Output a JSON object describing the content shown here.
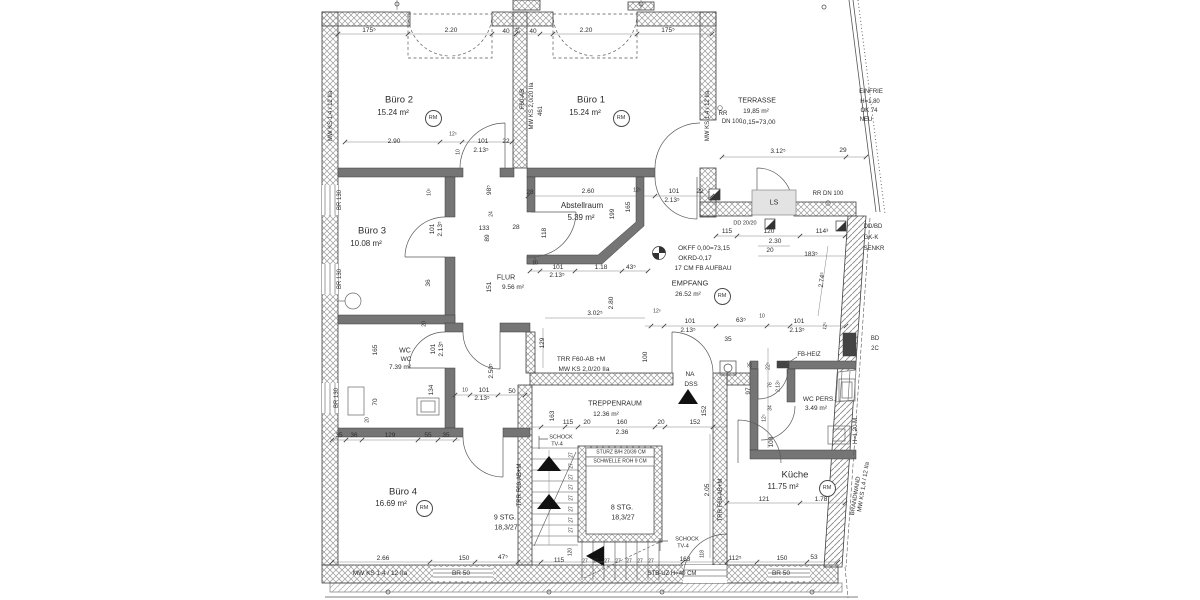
{
  "drawing_type": "architectural-floor-plan-office-storey",
  "rm_label": "RM",
  "rooms": [
    {
      "id": "buero-2",
      "name": "Büro 2",
      "area": "15.24 m²",
      "nx": 399,
      "ny": 100,
      "ax": 393,
      "ay": 113,
      "s": 9.5,
      "rx": 432,
      "ry": 117
    },
    {
      "id": "buero-1",
      "name": "Büro 1",
      "area": "15.24 m²",
      "nx": 591,
      "ny": 100,
      "ax": 585,
      "ay": 113,
      "s": 9.5,
      "rx": 620,
      "ry": 117
    },
    {
      "id": "buero-3",
      "name": "Büro 3",
      "area": "10.08 m²",
      "nx": 372,
      "ny": 231,
      "ax": 366,
      "ay": 244,
      "s": 9.5
    },
    {
      "id": "buero-4",
      "name": "Büro 4",
      "area": "16.69 m²",
      "nx": 403,
      "ny": 492,
      "ax": 391,
      "ay": 504,
      "s": 9.5,
      "rx": 423,
      "ry": 507
    },
    {
      "id": "abstellraum",
      "name": "Abstellraum",
      "area": "5.39 m²",
      "nx": 582,
      "ny": 206,
      "ax": 581,
      "ay": 218,
      "s": 8
    },
    {
      "id": "flur",
      "name": "FLUR",
      "area": "9.56 m²",
      "nx": 506,
      "ny": 278,
      "ax": 513,
      "ay": 288,
      "s": 7,
      "small": true
    },
    {
      "id": "wc",
      "name": "WC",
      "area": "7.39 m²",
      "nx": 405,
      "ny": 351,
      "ax": 400,
      "ay": 368,
      "s": 7,
      "small": true,
      "extra": "WC",
      "ex": 406,
      "ey": 360
    },
    {
      "id": "empfang",
      "name": "EMPFANG",
      "area": "26.52 m²",
      "nx": 690,
      "ny": 283,
      "ax": 688,
      "ay": 295,
      "s": 7.5,
      "small": true,
      "rx": 721,
      "ry": 295
    },
    {
      "id": "treppenraum",
      "name": "TREPPENRAUM",
      "area": "12.36 m²",
      "nx": 615,
      "ny": 404,
      "ax": 606,
      "ay": 415,
      "s": 7,
      "small": true
    },
    {
      "id": "wc-pers",
      "name": "WC PERS.",
      "area": "3.49 m²",
      "nx": 819,
      "ny": 400,
      "ax": 816,
      "ay": 409,
      "s": 6.5,
      "small": true
    },
    {
      "id": "kueche",
      "name": "Küche",
      "area": "11.75 m²",
      "nx": 795,
      "ny": 475,
      "ax": 783,
      "ay": 487,
      "s": 9.5,
      "rx": 826,
      "ry": 487
    },
    {
      "id": "terrasse",
      "name": "TERRASSE",
      "area": "19,85 m²",
      "nx": 757,
      "ny": 101,
      "ax": 756,
      "ay": 112,
      "s": 7,
      "small": true,
      "extra": "-0,15=73,00",
      "ex": 758,
      "ey": 123
    }
  ],
  "labels": [
    {
      "t": "175⁵",
      "x": 369,
      "y": 31
    },
    {
      "t": "2.20",
      "x": 451,
      "y": 31
    },
    {
      "t": "40",
      "x": 506,
      "y": 32
    },
    {
      "t": "24",
      "x": 519,
      "y": 30,
      "r": -90,
      "s": 5
    },
    {
      "t": "40",
      "x": 533,
      "y": 32
    },
    {
      "t": "2.20",
      "x": 586,
      "y": 31
    },
    {
      "t": "175⁵",
      "x": 668,
      "y": 31
    },
    {
      "n": "wall-spec",
      "t": "MW KS 1,4 / 12 IIa",
      "x": 331,
      "y": 116,
      "r": -90,
      "s": 6
    },
    {
      "n": "wall-spec",
      "t": "F60-AB",
      "x": 523,
      "y": 99,
      "r": -90,
      "s": 6
    },
    {
      "n": "wall-spec",
      "t": "MW KS 2,0/20 IIa",
      "x": 532,
      "y": 106,
      "r": -90,
      "s": 6
    },
    {
      "t": "461",
      "x": 541,
      "y": 111,
      "r": -90,
      "s": 6
    },
    {
      "n": "wall-spec",
      "t": "MW KS 1,4 / 12 IIa",
      "x": 708,
      "y": 116,
      "r": -90,
      "s": 6
    },
    {
      "t": "2.90",
      "x": 394,
      "y": 142
    },
    {
      "t": "12⁵",
      "x": 453,
      "y": 135,
      "s": 5
    },
    {
      "t": "10",
      "x": 459,
      "y": 152,
      "r": -90,
      "s": 5
    },
    {
      "t": "101",
      "x": 483,
      "y": 142
    },
    {
      "t": "2.13⁵",
      "x": 481,
      "y": 151
    },
    {
      "t": "22",
      "x": 506,
      "y": 142
    },
    {
      "t": "28",
      "x": 530,
      "y": 193
    },
    {
      "t": "2.60",
      "x": 588,
      "y": 192
    },
    {
      "t": "12⁵",
      "x": 637,
      "y": 191,
      "s": 5
    },
    {
      "t": "165",
      "x": 629,
      "y": 207,
      "r": -90
    },
    {
      "t": "199",
      "x": 613,
      "y": 214,
      "r": -90
    },
    {
      "t": "101",
      "x": 674,
      "y": 192
    },
    {
      "t": "2.13⁵",
      "x": 672,
      "y": 201
    },
    {
      "t": "22",
      "x": 700,
      "y": 192
    },
    {
      "t": "3.12⁵",
      "x": 778,
      "y": 152
    },
    {
      "t": "29",
      "x": 843,
      "y": 151
    },
    {
      "n": "drain-note",
      "t": "RR",
      "x": 723,
      "y": 114,
      "s": 6
    },
    {
      "n": "drain-note",
      "t": "DN 100",
      "x": 732,
      "y": 122,
      "s": 6
    },
    {
      "n": "fence-note",
      "t": "EINFRIE",
      "x": 871,
      "y": 92,
      "s": 6
    },
    {
      "n": "fence-note",
      "t": "H=1,80",
      "x": 870,
      "y": 102,
      "s": 6
    },
    {
      "n": "fence-note",
      "t": "OK 74",
      "x": 869,
      "y": 111,
      "s": 6
    },
    {
      "n": "fence-note",
      "t": "NEU",
      "x": 866,
      "y": 120,
      "s": 6
    },
    {
      "n": "shaft-label",
      "t": "LS",
      "x": 774,
      "y": 203,
      "s": 7
    },
    {
      "n": "drain-note",
      "t": "RR DN 100",
      "x": 828,
      "y": 194,
      "s": 6
    },
    {
      "n": "ceiling-note",
      "t": "DD 20/20",
      "x": 745,
      "y": 224,
      "s": 5.5
    },
    {
      "n": "ceiling-note",
      "t": "DD/BD",
      "x": 873,
      "y": 227,
      "s": 6
    },
    {
      "n": "ceiling-note",
      "t": "GK-K",
      "x": 871,
      "y": 238,
      "s": 6
    },
    {
      "n": "ceiling-note",
      "t": "SENKR",
      "x": 874,
      "y": 249,
      "s": 6
    },
    {
      "t": "115",
      "x": 727,
      "y": 232
    },
    {
      "t": "120",
      "x": 769,
      "y": 232
    },
    {
      "t": "114³",
      "x": 822,
      "y": 232
    },
    {
      "t": "2.30",
      "x": 775,
      "y": 242
    },
    {
      "t": "20",
      "x": 770,
      "y": 251
    },
    {
      "t": "183⁵",
      "x": 811,
      "y": 255
    },
    {
      "t": "2.74⁵",
      "x": 823,
      "y": 280,
      "r": -83
    },
    {
      "n": "level-note",
      "t": "OKFF 0,00=73,15",
      "x": 704,
      "y": 249,
      "s": 6.5
    },
    {
      "n": "level-note",
      "t": "OKRD-0,17",
      "x": 695,
      "y": 259,
      "s": 6.5
    },
    {
      "n": "level-note",
      "t": "17 CM FB AUFBAU",
      "x": 703,
      "y": 269,
      "s": 6.5
    },
    {
      "t": "98⁵",
      "x": 490,
      "y": 190,
      "r": -90
    },
    {
      "t": "24",
      "x": 492,
      "y": 214,
      "r": -90,
      "s": 5
    },
    {
      "t": "133",
      "x": 484,
      "y": 229
    },
    {
      "t": "28",
      "x": 516,
      "y": 228
    },
    {
      "t": "89",
      "x": 488,
      "y": 238,
      "r": -90
    },
    {
      "t": "118",
      "x": 545,
      "y": 233,
      "r": -90
    },
    {
      "t": "10⁵",
      "x": 430,
      "y": 192,
      "r": -90,
      "s": 5
    },
    {
      "t": "101",
      "x": 433,
      "y": 229,
      "r": -90
    },
    {
      "t": "2.13⁵",
      "x": 441,
      "y": 229,
      "r": -90
    },
    {
      "t": "36",
      "x": 429,
      "y": 283,
      "r": -90
    },
    {
      "t": "20",
      "x": 425,
      "y": 324,
      "r": -90,
      "s": 5
    },
    {
      "t": "151",
      "x": 490,
      "y": 287,
      "r": -90
    },
    {
      "t": "10",
      "x": 535,
      "y": 264,
      "s": 5
    },
    {
      "t": "101",
      "x": 558,
      "y": 268
    },
    {
      "t": "2.13⁵",
      "x": 557,
      "y": 276
    },
    {
      "t": "1.18",
      "x": 601,
      "y": 268
    },
    {
      "t": "43⁵",
      "x": 631,
      "y": 268
    },
    {
      "t": "3.02⁵",
      "x": 595,
      "y": 314
    },
    {
      "t": "2.80",
      "x": 612,
      "y": 303,
      "r": -90
    },
    {
      "t": "12⁵",
      "x": 657,
      "y": 312,
      "s": 5
    },
    {
      "t": "101",
      "x": 690,
      "y": 322
    },
    {
      "t": "2.13⁵",
      "x": 688,
      "y": 331
    },
    {
      "t": "63⁵",
      "x": 741,
      "y": 321
    },
    {
      "t": "10",
      "x": 762,
      "y": 317,
      "s": 5
    },
    {
      "t": "101",
      "x": 799,
      "y": 322
    },
    {
      "t": "2.13⁵",
      "x": 797,
      "y": 331
    },
    {
      "t": "12⁵",
      "x": 826,
      "y": 326,
      "r": -80,
      "s": 5
    },
    {
      "t": "129",
      "x": 543,
      "y": 343,
      "r": -90
    },
    {
      "t": "100",
      "x": 646,
      "y": 357,
      "r": -90
    },
    {
      "n": "wall-spec",
      "t": "TRR F60-AB +M",
      "x": 581,
      "y": 360,
      "s": 6.5
    },
    {
      "n": "wall-spec",
      "t": "MW KS 2,0/20 IIa",
      "x": 584,
      "y": 370,
      "s": 6.5
    },
    {
      "n": "vent-note",
      "t": "NA",
      "x": 690,
      "y": 375,
      "s": 6.5
    },
    {
      "n": "vent-note",
      "t": "DSS",
      "x": 691,
      "y": 385,
      "s": 6.5
    },
    {
      "t": "35",
      "x": 728,
      "y": 340
    },
    {
      "t": "35",
      "x": 751,
      "y": 365,
      "r": -90,
      "s": 5
    },
    {
      "t": "22⁵",
      "x": 769,
      "y": 366,
      "r": -90,
      "s": 5
    },
    {
      "t": "97",
      "x": 749,
      "y": 391,
      "r": -90
    },
    {
      "t": "76",
      "x": 771,
      "y": 385,
      "r": -90,
      "s": 5
    },
    {
      "t": "2.13⁵",
      "x": 779,
      "y": 386,
      "r": -90,
      "s": 5
    },
    {
      "t": "34",
      "x": 771,
      "y": 408,
      "r": -90,
      "s": 5
    },
    {
      "t": "12⁵",
      "x": 765,
      "y": 418,
      "r": -90,
      "s": 5
    },
    {
      "t": "100",
      "x": 772,
      "y": 442,
      "r": -90
    },
    {
      "n": "heating-note",
      "t": "FB-HEIZ",
      "x": 809,
      "y": 355,
      "s": 6
    },
    {
      "t": "165",
      "x": 376,
      "y": 350,
      "r": -90
    },
    {
      "t": "101",
      "x": 434,
      "y": 349,
      "r": -90
    },
    {
      "t": "2.13⁵",
      "x": 442,
      "y": 349,
      "r": -90
    },
    {
      "t": "2.50⁵",
      "x": 492,
      "y": 371,
      "r": -90
    },
    {
      "t": "134",
      "x": 432,
      "y": 390,
      "r": -90
    },
    {
      "t": "70",
      "x": 376,
      "y": 402,
      "r": -90
    },
    {
      "t": "20",
      "x": 368,
      "y": 420,
      "r": -90,
      "s": 5
    },
    {
      "t": "10",
      "x": 465,
      "y": 391,
      "s": 5
    },
    {
      "t": "101",
      "x": 484,
      "y": 391
    },
    {
      "t": "2.13⁵",
      "x": 482,
      "y": 399
    },
    {
      "t": "50",
      "x": 512,
      "y": 392
    },
    {
      "t": "35",
      "x": 339,
      "y": 436
    },
    {
      "t": "36",
      "x": 354,
      "y": 436
    },
    {
      "t": "129",
      "x": 390,
      "y": 436
    },
    {
      "t": "55",
      "x": 428,
      "y": 436
    },
    {
      "t": "35",
      "x": 446,
      "y": 436
    },
    {
      "t": "163",
      "x": 553,
      "y": 416,
      "r": -90
    },
    {
      "t": "115",
      "x": 568,
      "y": 423
    },
    {
      "t": "20",
      "x": 587,
      "y": 423
    },
    {
      "t": "160",
      "x": 622,
      "y": 423
    },
    {
      "t": "20",
      "x": 661,
      "y": 423
    },
    {
      "t": "152",
      "x": 695,
      "y": 423
    },
    {
      "t": "2.36",
      "x": 622,
      "y": 433
    },
    {
      "t": "152",
      "x": 705,
      "y": 411,
      "r": -90
    },
    {
      "t": "2.05",
      "x": 708,
      "y": 490,
      "r": -90
    },
    {
      "n": "lintel-note",
      "t": "STURZ B/H 20/39 CM",
      "x": 621,
      "y": 453,
      "s": 5
    },
    {
      "n": "lintel-note",
      "t": "SCHWELLE ROH 9 CM",
      "x": 620,
      "y": 462,
      "s": 5
    },
    {
      "n": "stair-note",
      "t": "8 STG.",
      "x": 622,
      "y": 508,
      "s": 7
    },
    {
      "n": "stair-note",
      "t": "18,3/27",
      "x": 623,
      "y": 518,
      "s": 7
    },
    {
      "n": "stair-note",
      "t": "9 STG.",
      "x": 505,
      "y": 518,
      "s": 7
    },
    {
      "n": "stair-note",
      "t": "18,3/27",
      "x": 506,
      "y": 528,
      "s": 7
    },
    {
      "n": "sound-insulation-note",
      "t": "SCHOCK",
      "x": 561,
      "y": 438,
      "s": 5.5
    },
    {
      "n": "sound-insulation-note",
      "t": "TV-4",
      "x": 557,
      "y": 445,
      "s": 5.5
    },
    {
      "n": "sound-insulation-note",
      "t": "SCHOCK",
      "x": 687,
      "y": 540,
      "s": 5.5
    },
    {
      "n": "sound-insulation-note",
      "t": "TV-4",
      "x": 683,
      "y": 547,
      "s": 5.5
    },
    {
      "n": "wall-spec",
      "t": "TRR F60-AB+M",
      "x": 520,
      "y": 485,
      "r": -90,
      "s": 6
    },
    {
      "n": "wall-spec",
      "t": "TRR F60-AB+M",
      "x": 721,
      "y": 500,
      "r": -90,
      "s": 6
    },
    {
      "t": "120",
      "x": 571,
      "y": 552,
      "r": -90,
      "s": 5
    },
    {
      "t": "118",
      "x": 703,
      "y": 554,
      "r": -90,
      "s": 5
    },
    {
      "t": "2.66",
      "x": 383,
      "y": 559
    },
    {
      "t": "150",
      "x": 464,
      "y": 559
    },
    {
      "t": "47⁵",
      "x": 503,
      "y": 558
    },
    {
      "t": "115",
      "x": 559,
      "y": 561
    },
    {
      "t": "163",
      "x": 685,
      "y": 560
    },
    {
      "t": "112⁵",
      "x": 735,
      "y": 559
    },
    {
      "t": "150",
      "x": 782,
      "y": 559
    },
    {
      "t": "53",
      "x": 814,
      "y": 558
    },
    {
      "n": "wall-spec",
      "t": "MW KS 1,4 / 12 IIa",
      "x": 380,
      "y": 574,
      "s": 6.5
    },
    {
      "n": "window-note",
      "t": "BR 50",
      "x": 461,
      "y": 574,
      "s": 6.5
    },
    {
      "n": "window-note",
      "t": "BR 50",
      "x": 781,
      "y": 574,
      "s": 6.5
    },
    {
      "n": "beam-note",
      "t": "STB-UZ H=40 CM",
      "x": 672,
      "y": 574,
      "s": 6
    },
    {
      "t": "121",
      "x": 764,
      "y": 500
    },
    {
      "t": "1.78",
      "x": 821,
      "y": 500
    },
    {
      "n": "parapet-note",
      "t": "H=1,20 M",
      "x": 856,
      "y": 431,
      "r": -90,
      "s": 6
    },
    {
      "n": "wall-spec",
      "t": "MW KS 1,4 / 12 IIa",
      "x": 864,
      "y": 487,
      "r": -81,
      "s": 6
    },
    {
      "n": "wall-spec",
      "t": "BRANDWAND",
      "x": 856,
      "y": 496,
      "r": -81,
      "s": 6
    },
    {
      "n": "ceiling-note",
      "t": "BD",
      "x": 875,
      "y": 339,
      "s": 6
    },
    {
      "n": "ceiling-note",
      "t": "2C",
      "x": 875,
      "y": 349,
      "s": 6
    },
    {
      "n": "window-note",
      "t": "BR 130",
      "x": 340,
      "y": 200,
      "r": -90,
      "s": 6
    },
    {
      "n": "window-note",
      "t": "BR 130",
      "x": 340,
      "y": 279,
      "r": -90,
      "s": 6
    },
    {
      "n": "window-note",
      "t": "BR 130",
      "x": 337,
      "y": 398,
      "r": -90,
      "s": 6
    },
    {
      "t": "27",
      "x": 572,
      "y": 455,
      "r": -90,
      "s": 5
    },
    {
      "t": "27",
      "x": 572,
      "y": 466,
      "r": -90,
      "s": 5
    },
    {
      "t": "27",
      "x": 572,
      "y": 477,
      "r": -90,
      "s": 5
    },
    {
      "t": "27",
      "x": 572,
      "y": 487,
      "r": -90,
      "s": 5
    },
    {
      "t": "27",
      "x": 572,
      "y": 498,
      "r": -90,
      "s": 5
    },
    {
      "t": "27",
      "x": 572,
      "y": 509,
      "r": -90,
      "s": 5
    },
    {
      "t": "27",
      "x": 572,
      "y": 520,
      "r": -90,
      "s": 5
    },
    {
      "t": "27",
      "x": 572,
      "y": 530,
      "r": -90,
      "s": 5
    },
    {
      "t": "27",
      "x": 585,
      "y": 562,
      "s": 5
    },
    {
      "t": "27",
      "x": 596,
      "y": 562,
      "s": 5
    },
    {
      "t": "27",
      "x": 607,
      "y": 562,
      "s": 5
    },
    {
      "t": "27",
      "x": 618,
      "y": 562,
      "s": 5
    },
    {
      "t": "27",
      "x": 629,
      "y": 562,
      "s": 5
    },
    {
      "t": "27",
      "x": 640,
      "y": 562,
      "s": 5
    },
    {
      "t": "27",
      "x": 651,
      "y": 562,
      "s": 5
    }
  ]
}
